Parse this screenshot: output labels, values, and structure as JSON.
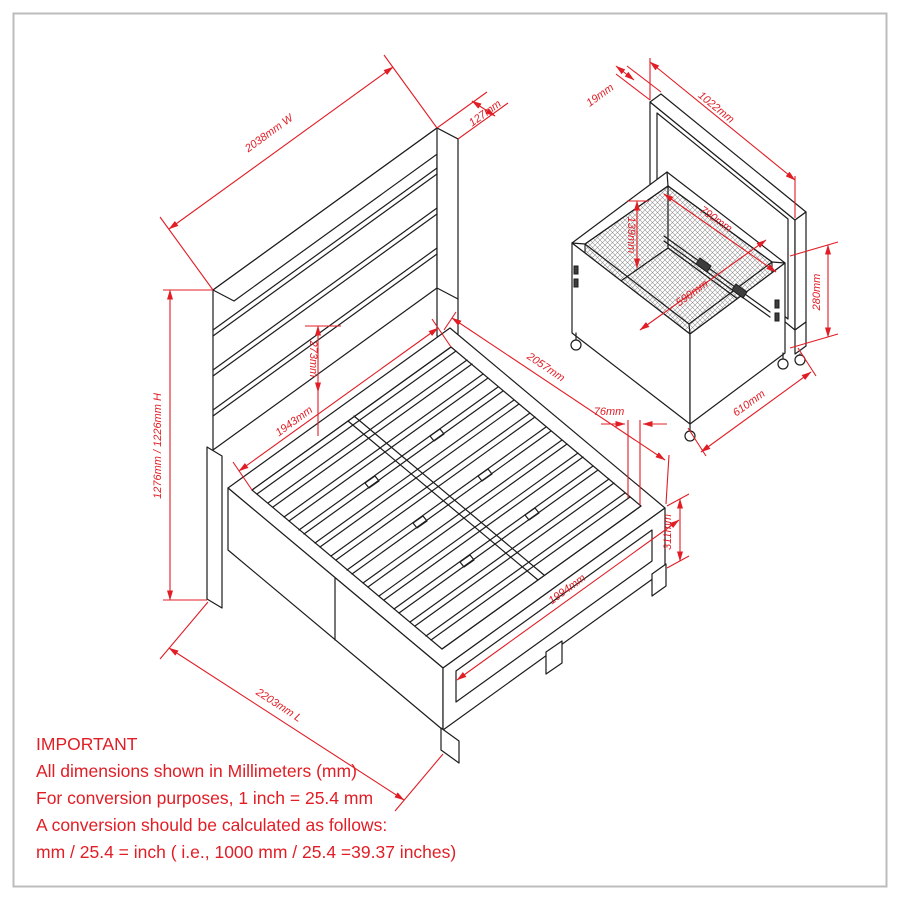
{
  "page": {
    "background": "#ffffff",
    "border_color": "#bcbcbc"
  },
  "colors": {
    "dimension_red": "#e11d25",
    "drawing_black": "#1c1c1c"
  },
  "bed_view": {
    "description": "isometric-bed-frame-with-headboard-and-slats",
    "dims": {
      "width": "2038mm W",
      "headboard_thickness": "127mm",
      "height": "1276mm / 1226mm H",
      "headboard_gap": "273mm",
      "inner_width": "1943mm",
      "inner_length": "2057mm",
      "slat_thickness": "76mm",
      "rail_height": "311mm",
      "slat_length": "1994mm",
      "length": "2203mm L"
    }
  },
  "storage_view": {
    "description": "isometric-storage-box-with-back-panel",
    "dims": {
      "panel_thickness": "19mm",
      "panel_width": "1022mm",
      "inner_length": "790mm",
      "inner_depth": "139mm",
      "inner_width": "590mm",
      "side_height": "280mm",
      "box_depth": "610mm"
    }
  },
  "notes": {
    "title": "IMPORTANT",
    "lines": [
      "All dimensions shown in Millimeters (mm)",
      "For conversion purposes, 1 inch = 25.4 mm",
      "A conversion should be calculated as follows:",
      "mm / 25.4 = inch ( i.e., 1000 mm / 25.4 =39.37 inches)"
    ]
  }
}
